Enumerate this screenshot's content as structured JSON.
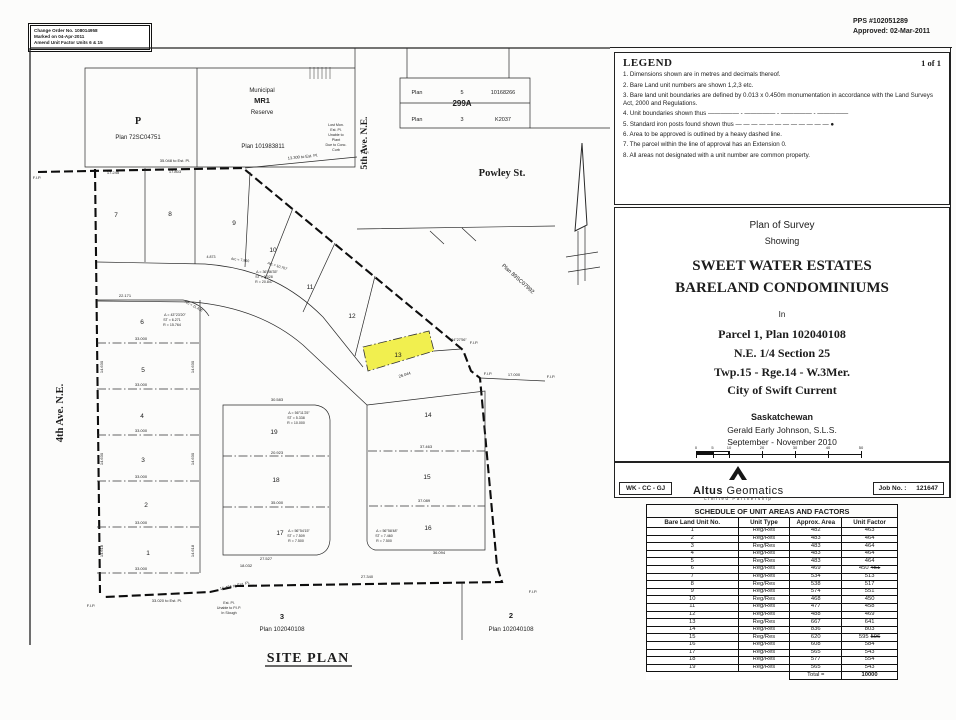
{
  "header": {
    "change_order": [
      "Change Order No. 108014958",
      "Marked on 04-Apr-2011",
      "Amend Unit Factor Units 6 & 15"
    ],
    "pps": [
      "PPS #102051289",
      "Approved: 02-Mar-2011"
    ]
  },
  "legend": {
    "title": "LEGEND",
    "page_label": "1 of 1",
    "items": [
      "1. Dimensions shown are in metres and decimals thereof.",
      "2. Bare Land unit numbers are shown 1,2,3 etc.",
      "3. Bare land unit boundaries are defined by 0.013 x 0.450m monumentation in accordance with the Land Surveys Act, 2000 and Regulations.",
      "4. Unit boundaries shown thus ————— - ————— - ————— - —————",
      "5. Standard iron posts found shown thus — — — — — — — — — — — — ●",
      "6. Area to be approved is outlined by a heavy dashed line.",
      "7. The parcel within the line of approval has an Extension 0.",
      "8. All areas not designated with a unit number are common property."
    ]
  },
  "title_block": {
    "plan_of_survey": "Plan of Survey",
    "showing": "Showing",
    "name1": "SWEET WATER ESTATES",
    "name2": "BARELAND CONDOMINIUMS",
    "in_word": "In",
    "parcel": "Parcel 1, Plan 102040108",
    "quarter": "N.E. 1/4 Section 25",
    "township": "Twp.15 - Rge.14 - W.3Mer.",
    "city": "City of Swift Current",
    "province": "Saskatchewan",
    "surveyor": "Gerald Early Johnson, S.L.S.",
    "dates": "September - November 2010",
    "scale_bar": {
      "ticks": [
        "0",
        "5",
        "10",
        "20",
        "30",
        "40",
        "50"
      ],
      "unit_label": "metres",
      "scale_text": "Scale - 1 : 500"
    }
  },
  "strip": {
    "crew": "WK - CC - GJ",
    "firm_bold": "Altus",
    "firm_rest": " Geomatics",
    "firm_sub": "Limited Partnership",
    "job_label": "Job No. :",
    "job_value": "121647"
  },
  "schedule": {
    "title": "SCHEDULE OF UNIT AREAS AND FACTORS",
    "columns": [
      "Bare Land Unit No.",
      "Unit Type",
      "Approx. Area",
      "Unit Factor"
    ],
    "rows": [
      {
        "unit": "1",
        "type": "Reg/Res",
        "area": "482",
        "factor": "463"
      },
      {
        "unit": "2",
        "type": "Reg/Res",
        "area": "483",
        "factor": "464"
      },
      {
        "unit": "3",
        "type": "Reg/Res",
        "area": "483",
        "factor": "464"
      },
      {
        "unit": "4",
        "type": "Reg/Res",
        "area": "483",
        "factor": "464"
      },
      {
        "unit": "5",
        "type": "Reg/Res",
        "area": "483",
        "factor": "464"
      },
      {
        "unit": "6",
        "type": "Reg/Res",
        "area": "469",
        "factor": "450",
        "superseded_factor": "451"
      },
      {
        "unit": "7",
        "type": "Reg/Res",
        "area": "534",
        "factor": "513"
      },
      {
        "unit": "8",
        "type": "Reg/Res",
        "area": "538",
        "factor": "517"
      },
      {
        "unit": "9",
        "type": "Reg/Res",
        "area": "574",
        "factor": "551"
      },
      {
        "unit": "10",
        "type": "Reg/Res",
        "area": "468",
        "factor": "450"
      },
      {
        "unit": "11",
        "type": "Reg/Res",
        "area": "477",
        "factor": "458"
      },
      {
        "unit": "12",
        "type": "Reg/Res",
        "area": "488",
        "factor": "469"
      },
      {
        "unit": "13",
        "type": "Reg/Res",
        "area": "667",
        "factor": "641"
      },
      {
        "unit": "14",
        "type": "Reg/Res",
        "area": "836",
        "factor": "803"
      },
      {
        "unit": "15",
        "type": "Reg/Res",
        "area": "620",
        "factor": "595",
        "superseded_factor": "596"
      },
      {
        "unit": "16",
        "type": "Reg/Res",
        "area": "608",
        "factor": "584"
      },
      {
        "unit": "17",
        "type": "Reg/Res",
        "area": "565",
        "factor": "543"
      },
      {
        "unit": "18",
        "type": "Reg/Res",
        "area": "577",
        "factor": "554"
      },
      {
        "unit": "19",
        "type": "Reg/Res",
        "area": "565",
        "factor": "543"
      }
    ],
    "total_label": "Total =",
    "total_value": "10000"
  },
  "site_plan": {
    "labels": {
      "ave4": "4th Ave. N.E.",
      "ave5": "5th Ave. N.E.",
      "powley": "Powley St.",
      "municipal_1": "Municipal",
      "municipal_2": "MR1",
      "municipal_3": "Reserve",
      "mr1_plan": "Plan 101983811",
      "p": "P",
      "p_plan": "Plan 72SC04751",
      "plan_89": "Plan 89SC07992",
      "t299_r1c1": "Plan",
      "t299_r1c2": "5",
      "t299_r1c3": "10168266",
      "t299_mid": "299A",
      "t299_r2c1": "Plan",
      "t299_r2c2": "3",
      "t299_r2c3": "K2037",
      "parcel3_no": "3",
      "parcel3_plan": "Plan 102040108",
      "parcel2_no": "2",
      "parcel2_plan": "Plan 102040108",
      "site_plan_title": "SITE PLAN"
    },
    "highlight_color": "#f0ed3c",
    "units": [
      {
        "no": "1",
        "x": 123,
        "y": 510
      },
      {
        "no": "2",
        "x": 121,
        "y": 462
      },
      {
        "no": "3",
        "x": 118,
        "y": 417
      },
      {
        "no": "4",
        "x": 117,
        "y": 373
      },
      {
        "no": "5",
        "x": 118,
        "y": 327
      },
      {
        "no": "6",
        "x": 117,
        "y": 279
      },
      {
        "no": "7",
        "x": 91,
        "y": 172
      },
      {
        "no": "8",
        "x": 145,
        "y": 171
      },
      {
        "no": "9",
        "x": 209,
        "y": 180
      },
      {
        "no": "10",
        "x": 248,
        "y": 207
      },
      {
        "no": "11",
        "x": 285,
        "y": 244
      },
      {
        "no": "12",
        "x": 327,
        "y": 273
      },
      {
        "no": "13",
        "x": 373,
        "y": 312
      },
      {
        "no": "14",
        "x": 403,
        "y": 372
      },
      {
        "no": "15",
        "x": 402,
        "y": 434
      },
      {
        "no": "16",
        "x": 403,
        "y": 485
      },
      {
        "no": "17",
        "x": 255,
        "y": 490
      },
      {
        "no": "18",
        "x": 251,
        "y": 437
      },
      {
        "no": "19",
        "x": 249,
        "y": 389
      }
    ],
    "annotations": [
      {
        "t": "35.048 to Est. Pl.",
        "x": 150,
        "y": 117
      },
      {
        "t": "17.245",
        "x": 88,
        "y": 129
      },
      {
        "t": "17.803",
        "x": 150,
        "y": 128
      },
      {
        "t": "13.300 to Est. Pl.",
        "x": 278,
        "y": 113,
        "r": -6
      },
      {
        "t": "F.I.P.",
        "x": 12,
        "y": 134
      },
      {
        "t": "F.I.P.",
        "x": 340,
        "y": 109
      },
      {
        "t": "F.I.P.",
        "x": 449,
        "y": 299
      },
      {
        "t": "F.I.P.",
        "x": 463,
        "y": 330
      },
      {
        "t": "17.000",
        "x": 489,
        "y": 331
      },
      {
        "t": "F.I.P.",
        "x": 526,
        "y": 333
      },
      {
        "t": "F.I.P.",
        "x": 66,
        "y": 562
      },
      {
        "t": "F.I.P.",
        "x": 508,
        "y": 548
      },
      {
        "t": "33.020 to Est. Pl.",
        "x": 142,
        "y": 557
      },
      {
        "t": "16.464 to Est. Pl.",
        "x": 210,
        "y": 542,
        "r": -12
      },
      {
        "t": "Est. Pl.",
        "x": 204,
        "y": 559,
        "s": 3.6
      },
      {
        "t": "Unable to P.I.P.",
        "x": 204,
        "y": 564,
        "s": 3.6
      },
      {
        "t": "In Slough",
        "x": 204,
        "y": 569,
        "s": 3.6
      },
      {
        "t": "27.340",
        "x": 342,
        "y": 533
      },
      {
        "t": "22.171",
        "x": 100,
        "y": 252
      },
      {
        "t": "33.000",
        "x": 116,
        "y": 295
      },
      {
        "t": "33.000",
        "x": 116,
        "y": 341
      },
      {
        "t": "33.000",
        "x": 116,
        "y": 387
      },
      {
        "t": "33.000",
        "x": 116,
        "y": 433
      },
      {
        "t": "33.000",
        "x": 116,
        "y": 479
      },
      {
        "t": "33.000",
        "x": 116,
        "y": 525
      },
      {
        "t": "14.630",
        "x": 78,
        "y": 322,
        "r": -90
      },
      {
        "t": "14.630",
        "x": 169,
        "y": 322,
        "r": -90
      },
      {
        "t": "14.630",
        "x": 78,
        "y": 414,
        "r": -90
      },
      {
        "t": "14.630",
        "x": 169,
        "y": 414,
        "r": -90
      },
      {
        "t": "14.618",
        "x": 78,
        "y": 506,
        "r": -90
      },
      {
        "t": "14.618",
        "x": 169,
        "y": 506,
        "r": -90
      },
      {
        "t": "30.583",
        "x": 252,
        "y": 356
      },
      {
        "t": "20.923",
        "x": 252,
        "y": 409
      },
      {
        "t": "35.000",
        "x": 252,
        "y": 459
      },
      {
        "t": "27.527",
        "x": 241,
        "y": 515
      },
      {
        "t": "18.032",
        "x": 221,
        "y": 522
      },
      {
        "t": "37.463",
        "x": 401,
        "y": 403
      },
      {
        "t": "37.089",
        "x": 399,
        "y": 457
      },
      {
        "t": "36.094",
        "x": 414,
        "y": 509
      },
      {
        "t": "26.044",
        "x": 380,
        "y": 331,
        "r": -17
      },
      {
        "t": "94°27'56\"",
        "x": 434,
        "y": 296,
        "s": 3.6
      },
      {
        "t": "Δ = 43°23'20\"",
        "x": 150,
        "y": 271,
        "s": 3.6
      },
      {
        "t": "ST = 6.271",
        "x": 147,
        "y": 276,
        "s": 3.6
      },
      {
        "t": "R = 15.764",
        "x": 147,
        "y": 281,
        "s": 3.6
      },
      {
        "t": "Δ = 56°11'25\"",
        "x": 274,
        "y": 369,
        "s": 3.6
      },
      {
        "t": "ST = 5.338",
        "x": 271,
        "y": 374,
        "s": 3.6
      },
      {
        "t": "R = 10.000",
        "x": 271,
        "y": 379,
        "s": 3.6
      },
      {
        "t": "Δ = 56°54'15\"",
        "x": 274,
        "y": 487,
        "s": 3.6
      },
      {
        "t": "ST = 7.509",
        "x": 271,
        "y": 492,
        "s": 3.6
      },
      {
        "t": "R = 7.500",
        "x": 271,
        "y": 497,
        "s": 3.6
      },
      {
        "t": "Δ = 56°58'48\"",
        "x": 362,
        "y": 487,
        "s": 3.6
      },
      {
        "t": "ST = 7.460",
        "x": 359,
        "y": 492,
        "s": 3.6
      },
      {
        "t": "R = 7.500",
        "x": 359,
        "y": 497,
        "s": 3.6
      },
      {
        "t": "Δ = 36°46'35\"",
        "x": 242,
        "y": 228,
        "s": 3.6
      },
      {
        "t": "ST = 3.028",
        "x": 239,
        "y": 233,
        "s": 3.6
      },
      {
        "t": "R = 20.847",
        "x": 239,
        "y": 238,
        "s": 3.6
      },
      {
        "t": "4.873",
        "x": 186,
        "y": 213,
        "s": 3.6
      },
      {
        "t": "Arc = 7.860",
        "x": 215,
        "y": 216,
        "s": 3.6,
        "r": 8
      },
      {
        "t": "Arc = 10.767",
        "x": 252,
        "y": 222,
        "s": 3.6,
        "r": 18
      },
      {
        "t": "Arc = 11.436",
        "x": 168,
        "y": 262,
        "s": 3.6,
        "r": 28
      },
      {
        "t": "Lost Mon.",
        "x": 311,
        "y": 81,
        "s": 3.6
      },
      {
        "t": "Est. Pl.",
        "x": 311,
        "y": 86,
        "s": 3.6
      },
      {
        "t": "Unable to",
        "x": 311,
        "y": 91,
        "s": 3.6
      },
      {
        "t": "Plant",
        "x": 311,
        "y": 96,
        "s": 3.6
      },
      {
        "t": "Due to Conc.",
        "x": 311,
        "y": 101,
        "s": 3.6
      },
      {
        "t": "Curb",
        "x": 311,
        "y": 106,
        "s": 3.6
      }
    ]
  }
}
